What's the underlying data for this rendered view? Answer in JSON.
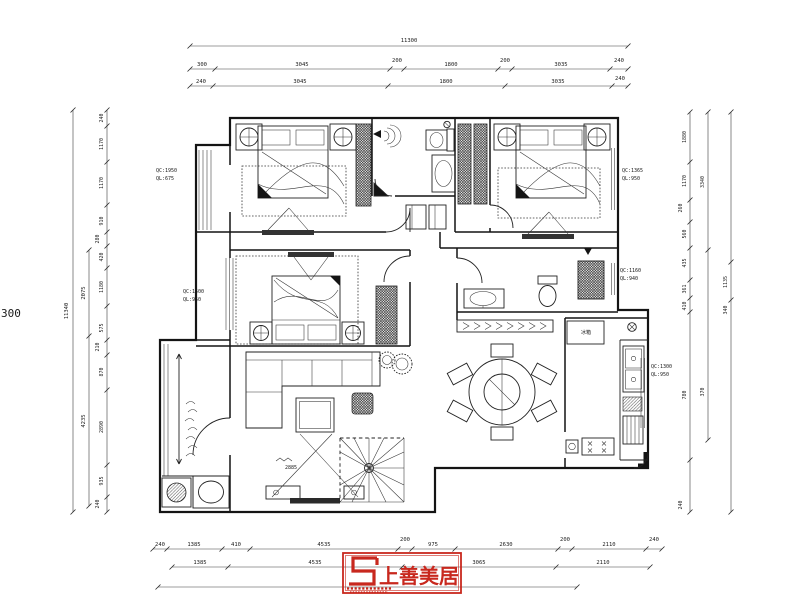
{
  "dims": {
    "total_top": "11300",
    "top2": [
      "300",
      "3045",
      "200",
      "1800",
      "200",
      "3035",
      "240"
    ],
    "top3": [
      "240",
      "3045",
      "1800",
      "3035",
      "240"
    ],
    "left_total": "11340",
    "left_mid": [
      "2075",
      "4235"
    ],
    "left_inner": [
      "240",
      "1170",
      "1170",
      "910",
      "280",
      "420",
      "1180",
      "575",
      "210",
      "870",
      "2890",
      "935",
      "240"
    ],
    "right_inner": [
      "1880",
      "1170",
      "260",
      "560",
      "435",
      "361",
      "410",
      "780",
      "240"
    ],
    "right_mid": [
      "3340",
      "370"
    ],
    "right_outer": [
      "1135",
      "340"
    ],
    "bottom1": [
      "240",
      "1385",
      "410",
      "4535",
      "200",
      "975",
      "2630",
      "200",
      "2110",
      "240"
    ],
    "bottom2": [
      "1385",
      "4535",
      "3065",
      "2110"
    ],
    "margin_note": "300",
    "living_tv": "2885"
  },
  "window_labels": {
    "left_top": {
      "line1": "QC:1950",
      "line2": "QL:675"
    },
    "left_middle": {
      "line1": "QC:1500",
      "line2": "QL:950"
    },
    "right_top": {
      "line1": "QC:1365",
      "line2": "QL:950"
    },
    "right_middle": {
      "line1": "QC:1160",
      "line2": "QL:940"
    },
    "right_lower": {
      "line1": "QC:1300",
      "line2": "QL:950"
    }
  },
  "labels": {
    "fridge": "冰箱"
  },
  "logo": {
    "company_name": "上善美居"
  },
  "colors": {
    "drawing_line": "#1a1a1a",
    "stamp_red": "#c8281e",
    "background": "#ffffff"
  }
}
